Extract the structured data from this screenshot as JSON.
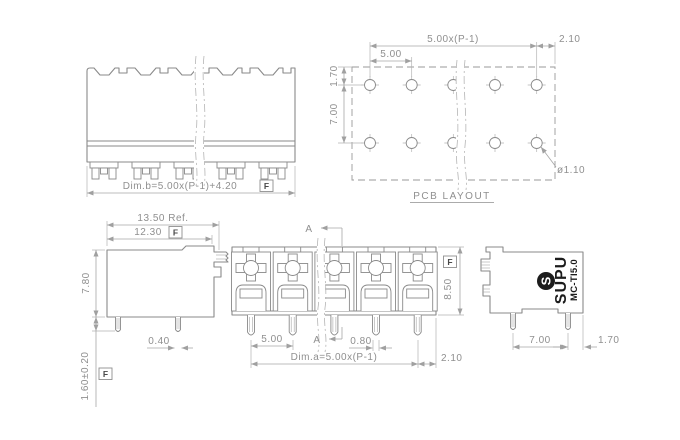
{
  "drawing": {
    "rear_view": {
      "dim_b": "Dim.b=5.00x(P-1)+4.20",
      "flag": "F"
    },
    "pcb_layout": {
      "label": "PCB LAYOUT",
      "dim_span": "5.00x(P-1)",
      "dim_edge": "2.10",
      "dim_pitch": "5.00",
      "dim_top_offset": "1.70",
      "dim_row_gap": "7.00",
      "dim_hole_dia": "ø1.10"
    },
    "left_view": {
      "dim_depth_ref": "13.50 Ref.",
      "dim_depth": "12.30",
      "flag": "F",
      "dim_height": "7.80",
      "dim_pin_width": "0.40",
      "dim_pin_length": "1.60±0.20",
      "flag2": "F"
    },
    "front_view": {
      "section_label": "A",
      "dim_pitch": "5.00",
      "dim_pin_width": "0.80",
      "dim_a": "Dim.a=5.00x(P-1)",
      "dim_edge": "2.10",
      "dim_height": "8.50",
      "flag": "F"
    },
    "right_view": {
      "brand": "SUPU",
      "brand_initial": "S",
      "model": "MC-TI5.0",
      "dim_pin_span": "7.00",
      "dim_edge": "1.70"
    }
  },
  "colors": {
    "background": "#ffffff",
    "line": "#8a8a8a",
    "dim_line": "#a6a6a6",
    "text": "#8f8f8f",
    "logo": "#1c1c1c"
  }
}
